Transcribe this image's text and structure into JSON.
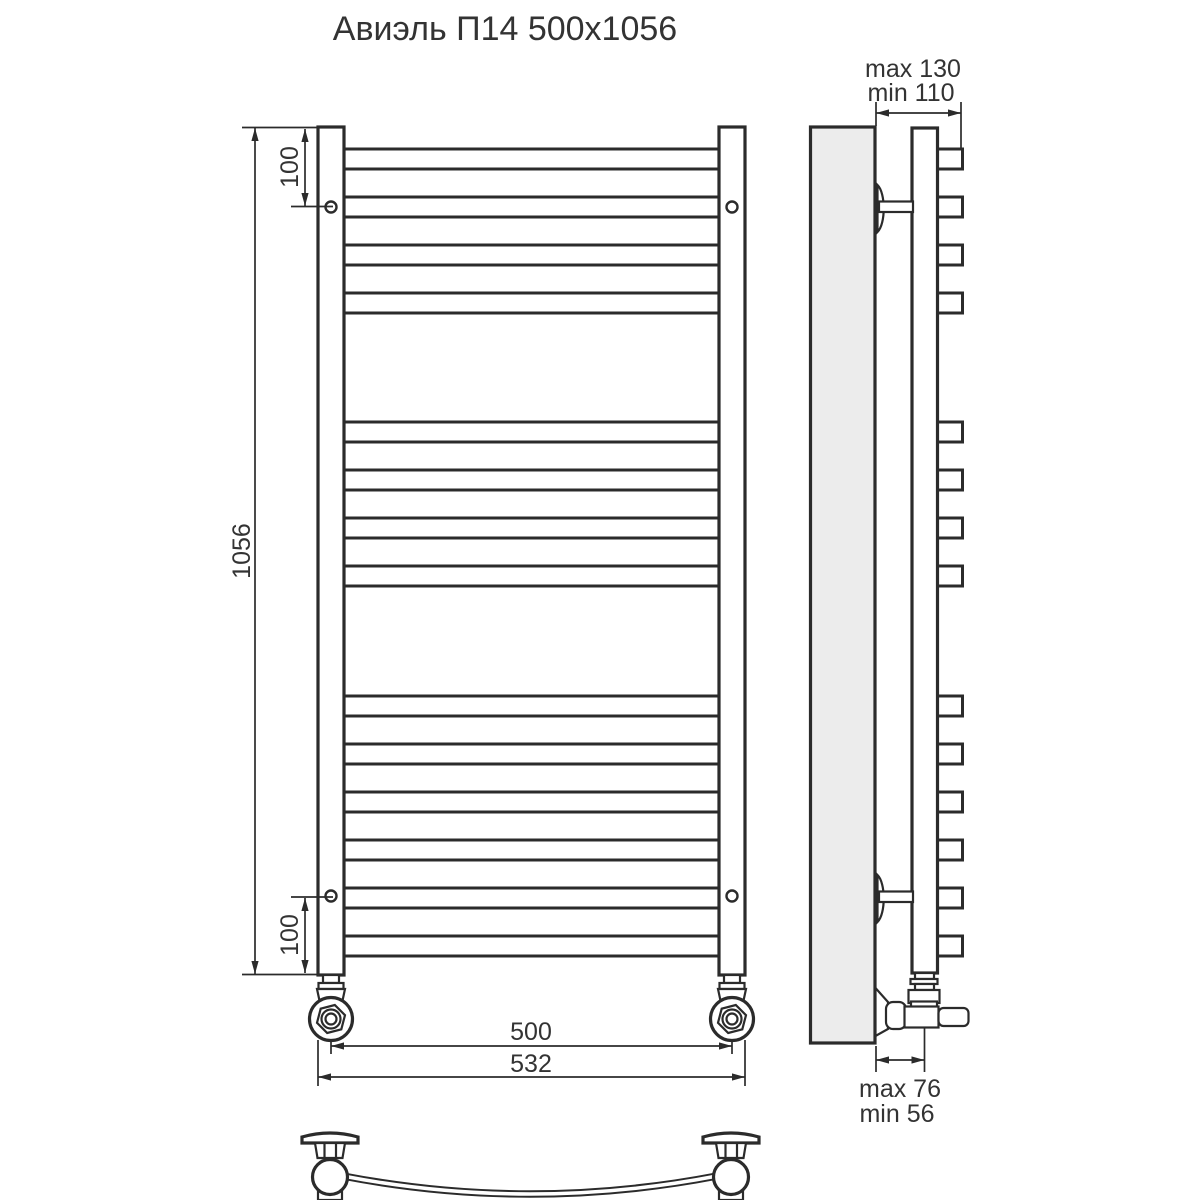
{
  "title": "Авиэль П14 500x1056",
  "front_view": {
    "dim_height": "1056",
    "dim_top_hole_offset": "100",
    "dim_bottom_hole_offset": "100",
    "dim_width_centers": "500",
    "dim_width_overall": "532",
    "rung_count": 14,
    "rung_groups": [
      4,
      4,
      6
    ]
  },
  "side_view": {
    "dim_wall_to_front_max": "max 130",
    "dim_wall_to_front_min": "min 110",
    "dim_wall_to_pipe_max": "max 76",
    "dim_wall_to_pipe_min": "min 56"
  },
  "colors": {
    "line": "#2b2b2b",
    "wall_fill": "#ececec",
    "text": "#333333"
  }
}
